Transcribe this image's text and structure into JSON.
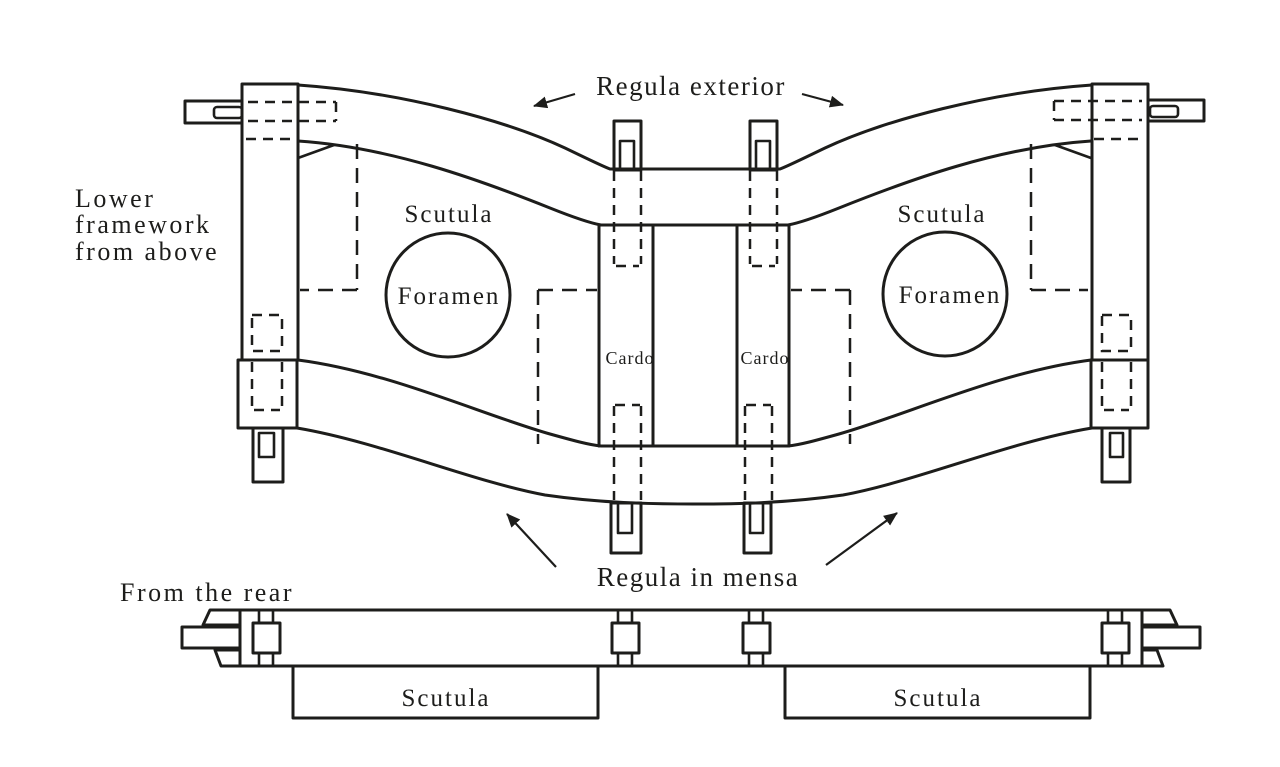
{
  "colors": {
    "ink": "#1d1d1b",
    "paper": "#ffffff"
  },
  "figure": {
    "top_view": {
      "caption_lines": [
        "Lower",
        "framework",
        "from above"
      ],
      "labels": {
        "regula_exterior": "Regula exterior",
        "regula_in_mensa": "Regula in mensa",
        "scutula_left": "Scutula",
        "scutula_right": "Scutula",
        "foramen_left": "Foramen",
        "foramen_right": "Foramen",
        "cardo_left": "Cardo",
        "cardo_right": "Cardo"
      }
    },
    "rear_view": {
      "caption": "From the rear",
      "labels": {
        "scutula_left": "Scutula",
        "scutula_right": "Scutula"
      }
    }
  }
}
